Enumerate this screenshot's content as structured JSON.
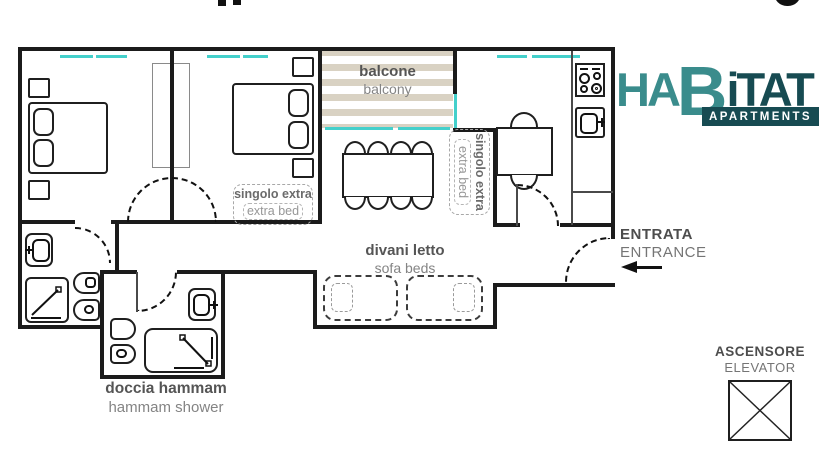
{
  "logo": {
    "part_teal_1": "HA",
    "part_teal_2": "B",
    "part_dark": "iTAT",
    "badge": "APARTMENTS"
  },
  "plan": {
    "balcony": {
      "label_it": "balcone",
      "label_en": "balcony"
    },
    "sofa_beds": {
      "label_it": "divani letto",
      "label_en": "sofa beds"
    },
    "hammam": {
      "label_it": "doccia hammam",
      "label_en": "hammam shower"
    },
    "bedroom_extra_bed": {
      "label_it": "singolo extra",
      "label_en": "extra bed"
    },
    "living_extra_bed": {
      "label_it": "singolo extra",
      "label_en": "extra bed"
    },
    "entrance": {
      "label_it": "ENTRATA",
      "label_en": "ENTRANCE"
    },
    "elevator": {
      "label_it": "ASCENSORE",
      "label_en": "ELEVATOR"
    }
  },
  "colors": {
    "wall": "#1b1b1b",
    "window_teal": "#44d0cb",
    "balcony_stripe": "#d9d2c3",
    "logo_teal": "#3a8c8c",
    "logo_dark": "#174b52",
    "label_dark": "#555555",
    "label_light": "#848484"
  }
}
